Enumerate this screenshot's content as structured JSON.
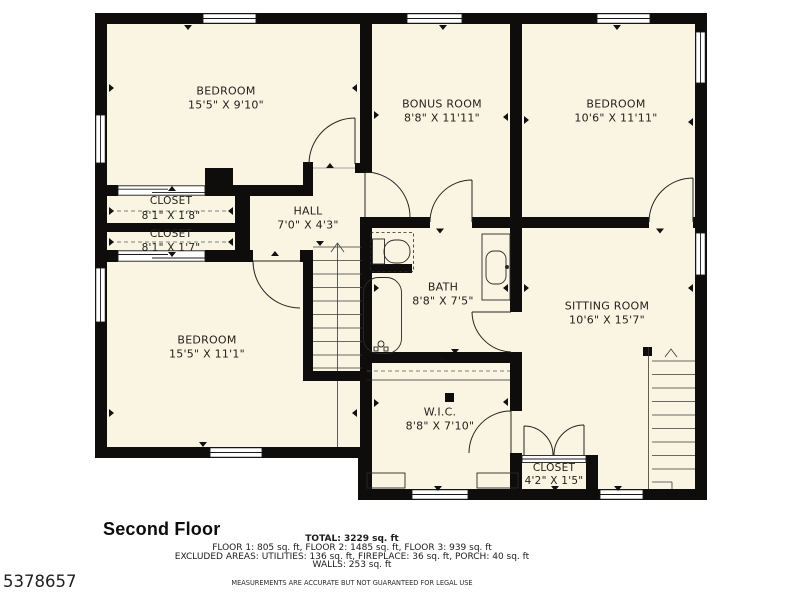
{
  "listing_id": "5378657",
  "floor_title": "Second Floor",
  "summary": {
    "total": "TOTAL: 3229 sq. ft",
    "floors": "FLOOR 1: 805 sq. ft, FLOOR 2: 1485 sq. ft, FLOOR 3: 939 sq. ft",
    "excluded": "EXCLUDED AREAS: UTILITIES: 136 sq. ft, FIREPLACE: 36 sq. ft, PORCH: 40 sq. ft",
    "walls": "WALLS: 253 sq. ft",
    "disclaimer": "MEASUREMENTS ARE ACCURATE BUT NOT GUARANTEED FOR LEGAL USE"
  },
  "rooms": {
    "bedroom_tl": {
      "name": "BEDROOM",
      "dims": "15'5\" X 9'10\""
    },
    "bonus": {
      "name": "BONUS ROOM",
      "dims": "8'8\" X 11'11\""
    },
    "bedroom_tr": {
      "name": "BEDROOM",
      "dims": "10'6\" X 11'11\""
    },
    "closet1": {
      "name": "CLOSET",
      "dims": "8'1\" X 1'8\""
    },
    "closet2": {
      "name": "CLOSET",
      "dims": "8'1\" X 1'7\""
    },
    "hall": {
      "name": "HALL",
      "dims": "7'0\" X 4'3\""
    },
    "bath": {
      "name": "BATH",
      "dims": "8'8\" X 7'5\""
    },
    "sitting": {
      "name": "SITTING ROOM",
      "dims": "10'6\" X 15'7\""
    },
    "bedroom_bl": {
      "name": "BEDROOM",
      "dims": "15'5\" X 11'1\""
    },
    "wic": {
      "name": "W.I.C.",
      "dims": "8'8\" X 7'10\""
    },
    "closet3": {
      "name": "CLOSET",
      "dims": "4'2\" X 1'5\""
    }
  },
  "colors": {
    "wall": "#0f0d0b",
    "floor": "#faf5e3",
    "line": "#2b2926",
    "background": "#ffffff"
  }
}
